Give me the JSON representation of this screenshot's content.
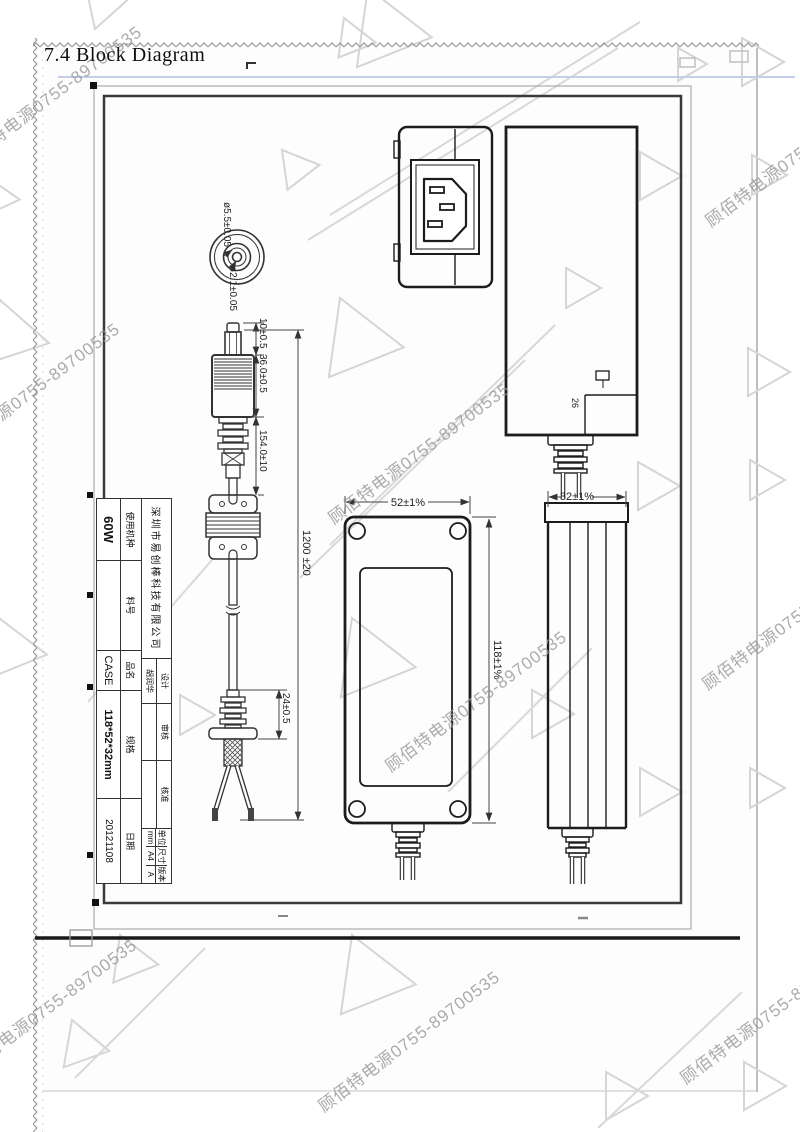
{
  "page": {
    "heading": "7.4 Block Diagram"
  },
  "watermark": {
    "text": "顾佰特电源0755-89700535",
    "color": "#a8a8a8"
  },
  "dimensions": {
    "plug_outer_dia": "ø5.5±0.05",
    "plug_inner_dia": "ø2.1±0.05",
    "tip_length": "10±0.5",
    "plug_body_length": "36.0±0.5",
    "plug_lead_length": "154.0±10",
    "cable_length": "1200 ±20",
    "tail_bushing_length": "24±0.5",
    "case_width": "52±1%",
    "case_length": "118±1%",
    "case_thickness": "32±1%",
    "side_note": "26"
  },
  "title_block": {
    "company": "深圳市易创棒科技有限公司",
    "model_label": "使用机种",
    "model_value": "60W",
    "part_label": "料号",
    "part_value": "",
    "name_label": "品名",
    "name_value": "CASE",
    "spec_label": "规格",
    "spec_value": "118*52*32mm",
    "date_label": "日期",
    "date_value": "20121108",
    "design_label": "设计",
    "design_value": "胡润华",
    "review_label": "审核",
    "review_value": "",
    "approve_label": "核准",
    "approve_value": "",
    "unit_label": "单位",
    "unit_value": "mm",
    "size_label": "尺寸",
    "size_value": "A4",
    "version_label": "版本",
    "version_value": "A"
  }
}
